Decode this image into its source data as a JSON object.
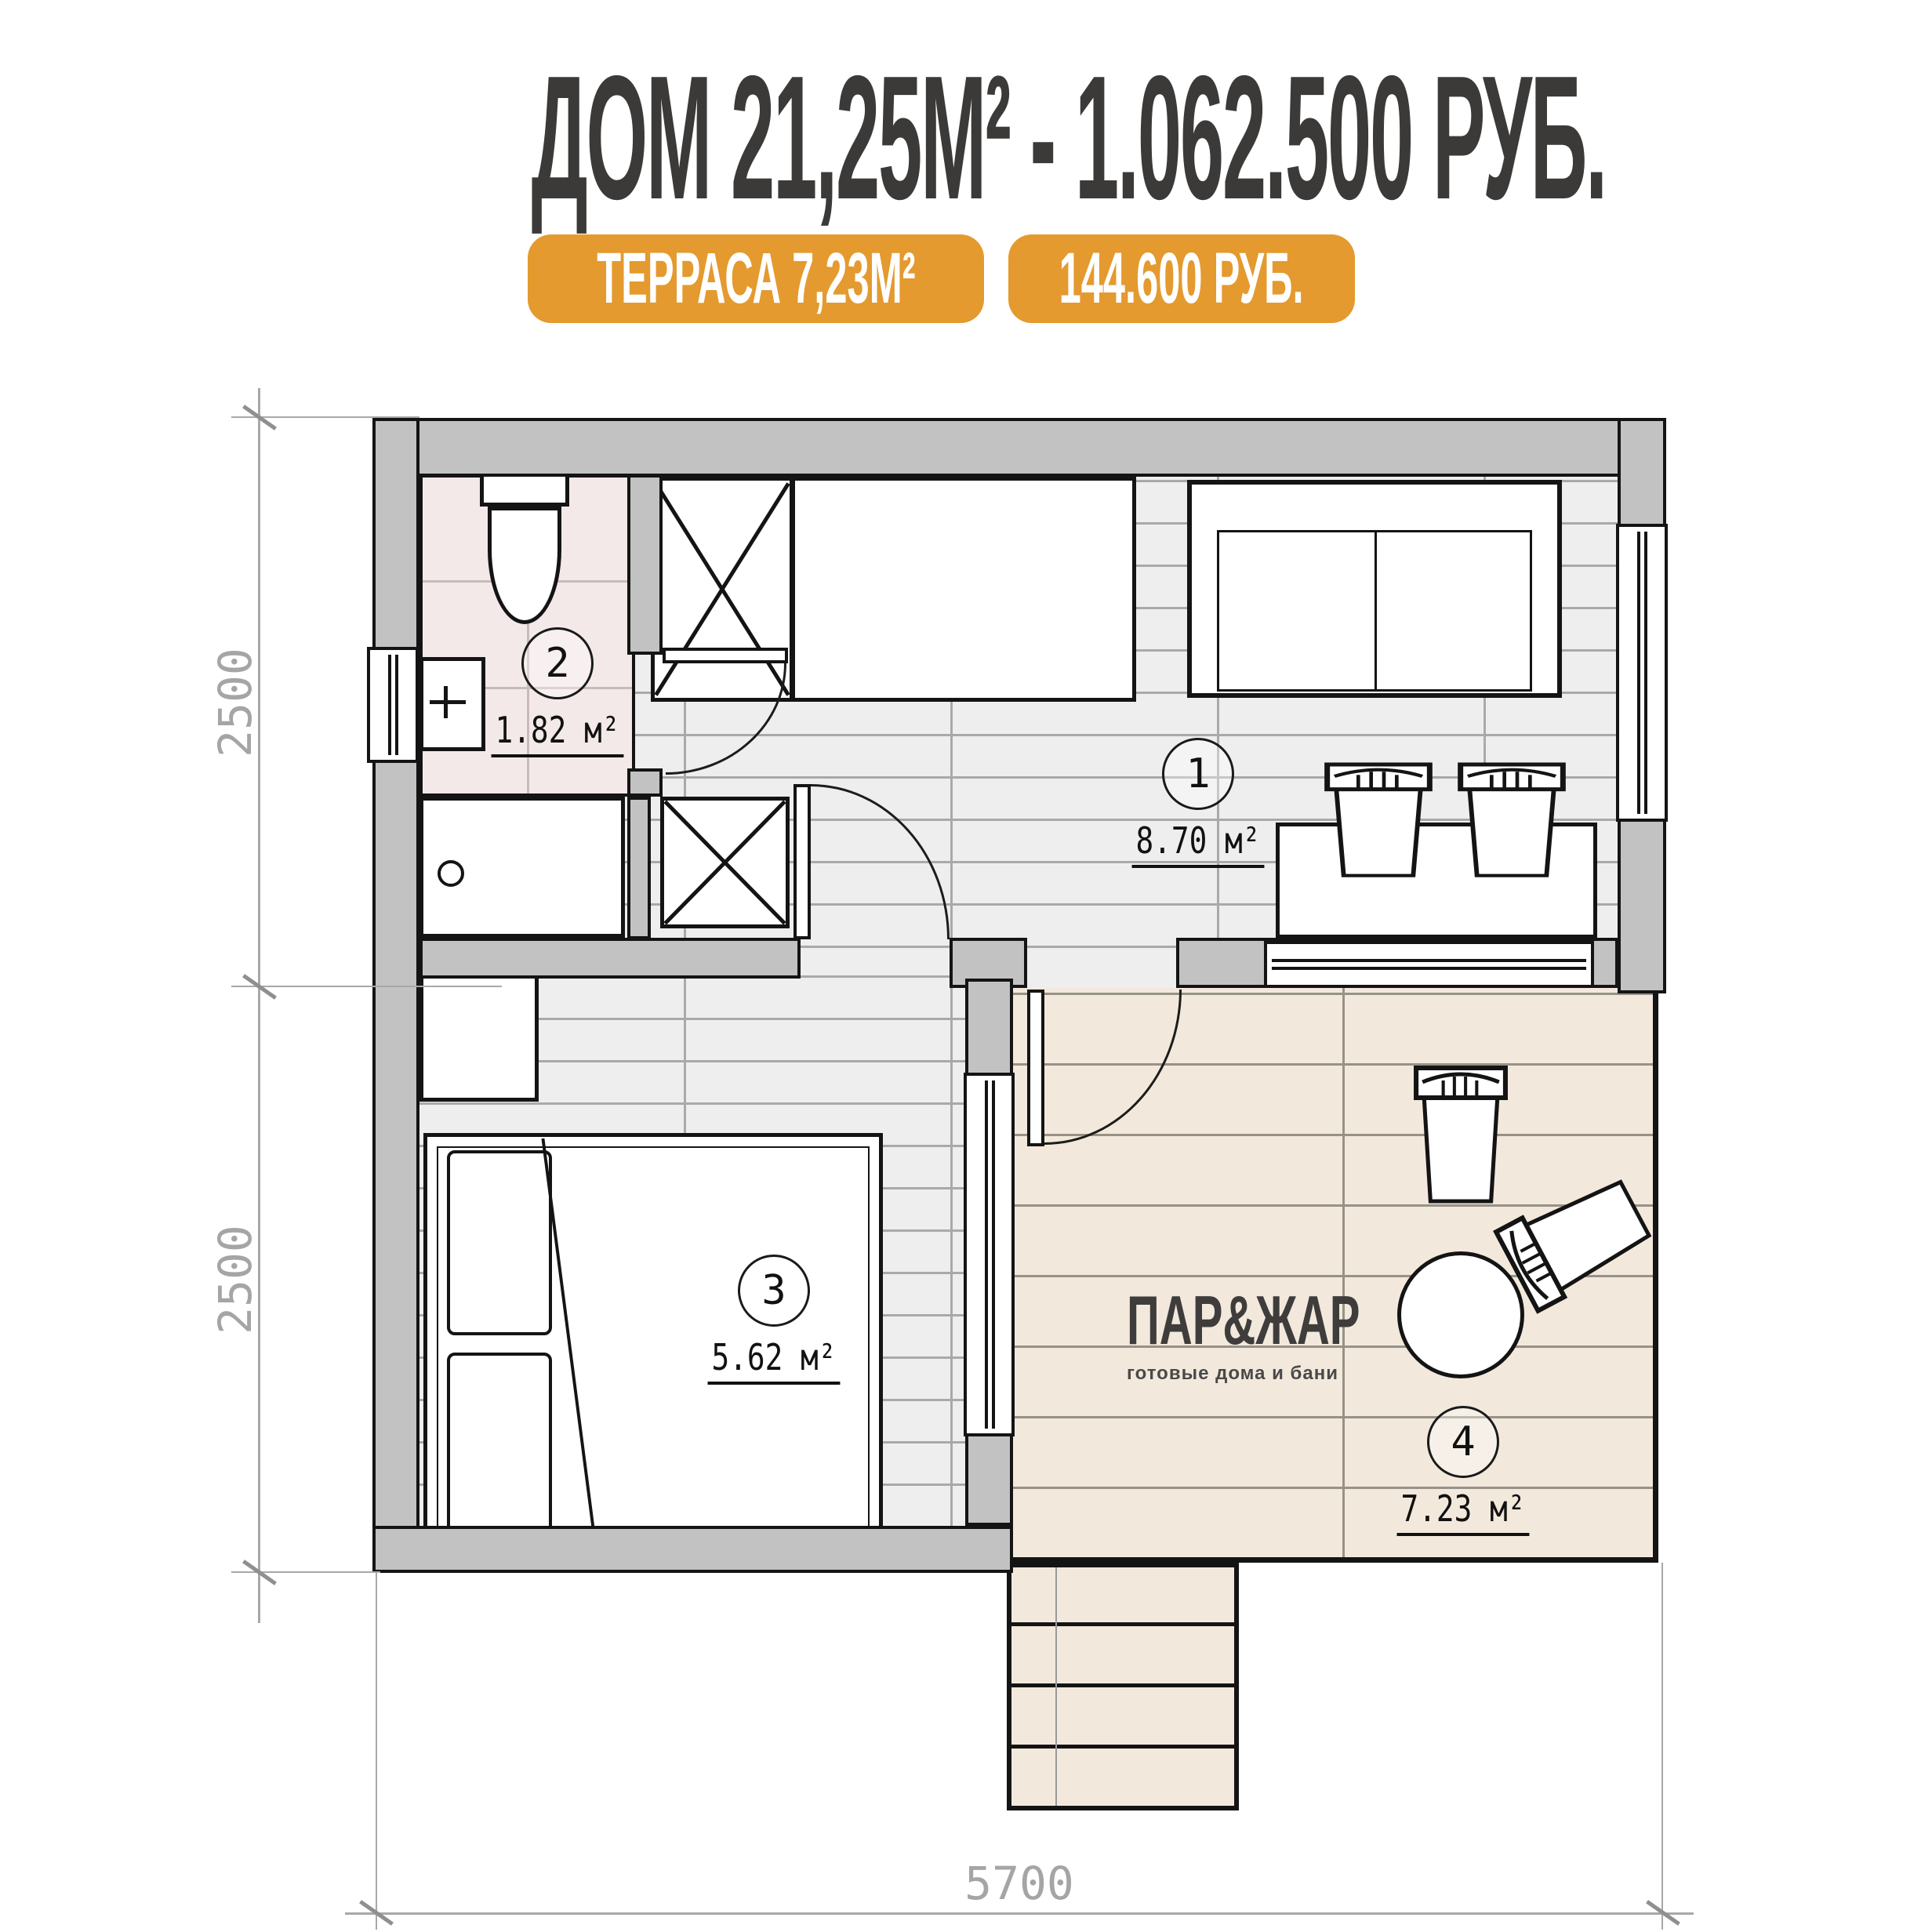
{
  "header": {
    "title": "ДОМ 21,25М² - 1.062.500 РУБ.",
    "badge_terrace": "ТЕРРАСА 7,23М²",
    "badge_price": "144.600 РУБ."
  },
  "plan": {
    "rooms": [
      {
        "id": "living-kitchen",
        "number": "1",
        "area": "8.70 м²"
      },
      {
        "id": "bathroom",
        "number": "2",
        "area": "1.82 м²"
      },
      {
        "id": "bedroom",
        "number": "3",
        "area": "5.62 м²"
      },
      {
        "id": "terrace",
        "number": "4",
        "area": "7.23 м²"
      }
    ],
    "dimensions": {
      "left_top": "2500",
      "left_bottom": "2500",
      "bottom": "5700"
    },
    "logo": {
      "brand": "ПАР&ЖАР",
      "tagline": "готовые дома и бани"
    }
  },
  "colors": {
    "accent_orange": "#E49A2E",
    "title_text": "#3B3A39",
    "wall_fill": "#C3C2C3",
    "outline": "#141414",
    "wood_floor": "#EFEEEF",
    "terrace_floor": "#F2E9DC",
    "bathroom_floor": "#F4E9E9",
    "dimension_text": "#A5A5A5"
  }
}
